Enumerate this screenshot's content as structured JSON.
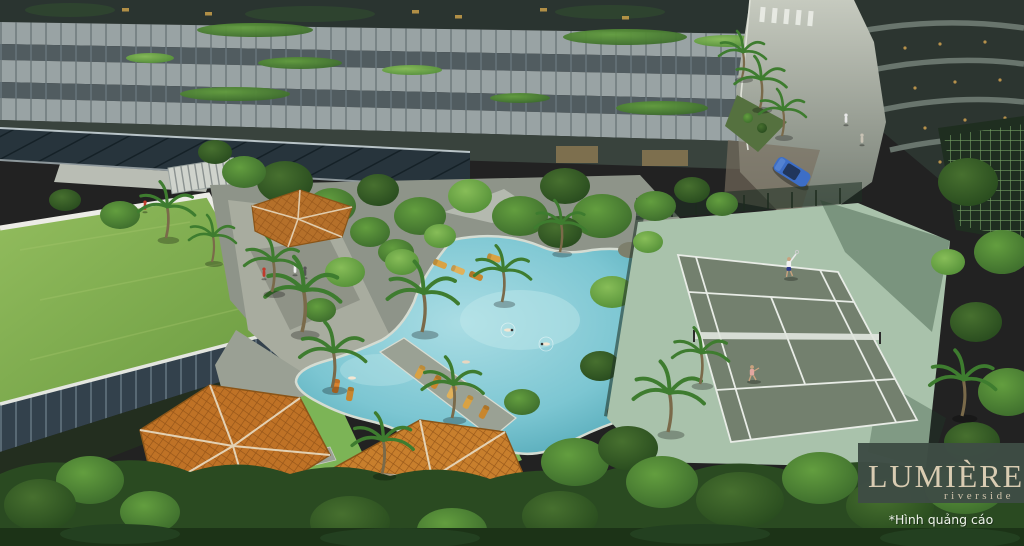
{
  "logo": {
    "brand": "LUMIÈRE",
    "tagline": "riverside",
    "disclaimer": "*Hình quảng cáo"
  },
  "colors": {
    "logo_bg": "#3e4c44",
    "logo_text": "#d9ccb2",
    "logo_tagline": "#cfc2ab",
    "disclaimer_text": "#eef3ea",
    "pool_water": "#7cc6d2",
    "pool_edge": "#2d7685",
    "court_inner": "#73806e",
    "court_apron": "#a9c2ab",
    "court_line": "#e8ece6",
    "green_roof": "#82b050",
    "pavilion_roof": "#bf7226",
    "facade_band": "#99a3a4",
    "facade_glass": "#2a3430",
    "road": "#b7bcb2",
    "car": "#3d6ec6",
    "lawn": "#7cb456",
    "foliage_dark": "#2a4a21"
  },
  "scene": {
    "features": [
      "residential-tower-facade",
      "second-tower",
      "driveway-with-palms",
      "green-roof-podium",
      "landscaped-lagoon-pool",
      "sun-loungers",
      "tennis-court",
      "tennis-players",
      "garden-pavilions",
      "blue-car"
    ]
  }
}
